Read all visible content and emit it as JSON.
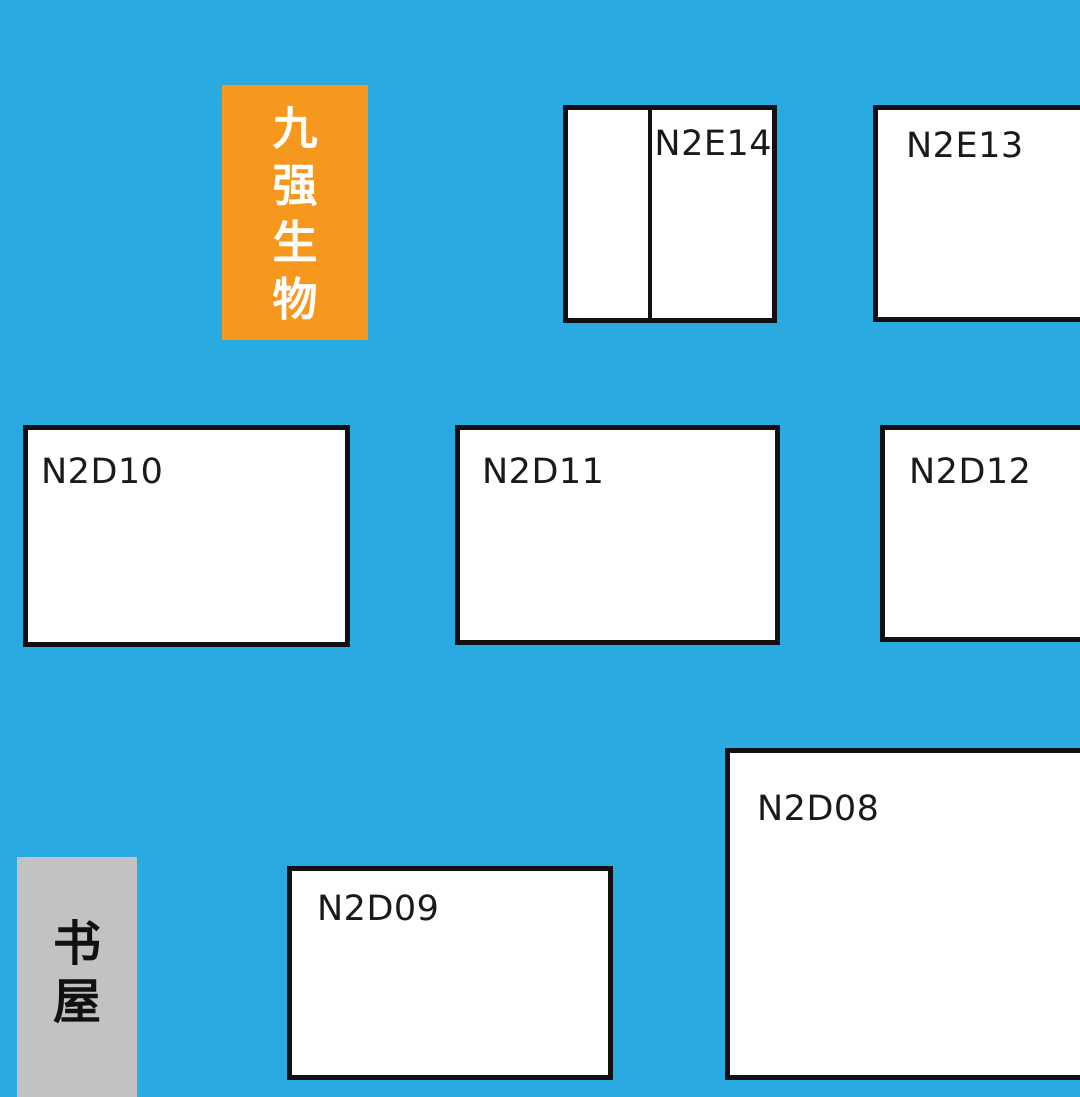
{
  "map_title": "exhibition-floor-plan",
  "colors": {
    "background": "#29ABE2",
    "booth_fill": "#FFFFFF",
    "booth_border": "#111111",
    "label_text": "#1A1A1A",
    "brand_bg": "#F7981E",
    "brand_text": "#FFFFFF",
    "book_house_bg": "#C1C2C4",
    "book_house_text": "#111111"
  },
  "brand_box": {
    "text": "九强生物"
  },
  "book_house": {
    "text": "书屋"
  },
  "booths": [
    {
      "id": "N2E14",
      "label": "N2E14",
      "note": "split into two cells, label in right cell"
    },
    {
      "id": "N2E13",
      "label": "N2E13"
    },
    {
      "id": "N2D10",
      "label": "N2D10"
    },
    {
      "id": "N2D11",
      "label": "N2D11"
    },
    {
      "id": "N2D12",
      "label": "N2D12"
    },
    {
      "id": "N2D08",
      "label": "N2D08"
    },
    {
      "id": "N2D09",
      "label": "N2D09"
    }
  ]
}
